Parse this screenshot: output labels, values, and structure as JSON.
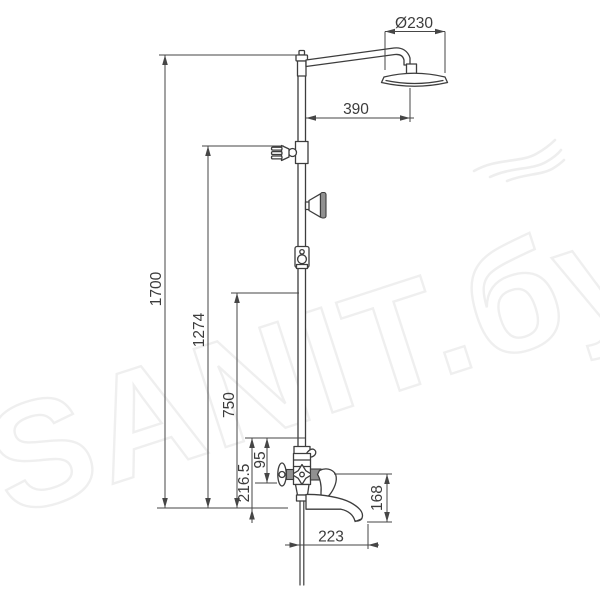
{
  "watermark": {
    "text": "SANIT.бу",
    "logo": "wave-swirl-icon"
  },
  "colors": {
    "background": "#ffffff",
    "drawing_line": "#3d3d3d",
    "dimension_line": "#464646",
    "dimension_text": "#3c3c3c",
    "watermark": "#efefef",
    "hatch_fill": "#919191"
  },
  "dimensions": {
    "head_diameter": "Ø230",
    "arm_reach": "390",
    "total_height": "1700",
    "holder_height": "1274",
    "supply_height": "750",
    "mixer_height": "216.5",
    "valve_offset": "95",
    "spout_drop": "168",
    "spout_reach": "223"
  }
}
